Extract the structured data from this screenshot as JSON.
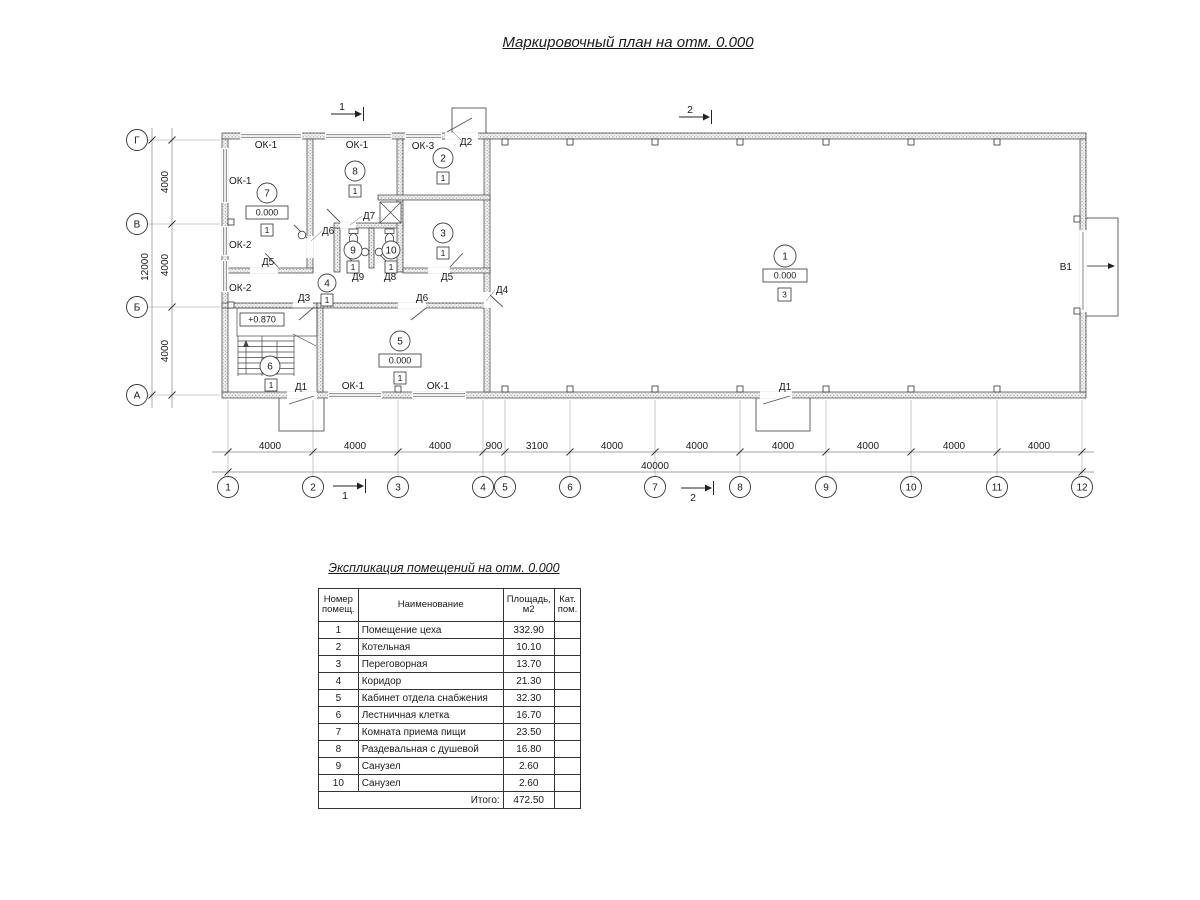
{
  "plan": {
    "title": "Маркировочный план на отм. 0.000",
    "col_axes": [
      "1",
      "2",
      "3",
      "4",
      "5",
      "6",
      "7",
      "8",
      "9",
      "10",
      "11",
      "12"
    ],
    "row_axes": [
      "Г",
      "В",
      "Б",
      "А"
    ],
    "dims_bottom": [
      "4000",
      "4000",
      "4000",
      "900",
      "3100",
      "4000",
      "4000",
      "4000",
      "4000",
      "4000",
      "4000"
    ],
    "total_width": "40000",
    "dims_left": [
      "4000",
      "4000",
      "4000"
    ],
    "total_height": "12000",
    "sections": {
      "s1": "1",
      "s2": "2"
    },
    "gate_label": "В1",
    "landing_level": "+0.870",
    "doors": [
      "Д2",
      "Д6",
      "Д7",
      "Д9",
      "Д8",
      "Д5",
      "Д5",
      "Д4",
      "Д3",
      "Д6",
      "Д1",
      "Д1"
    ],
    "windows": [
      "ОК-1",
      "ОК-1",
      "ОК-3",
      "ОК-1",
      "ОК-2",
      "ОК-2",
      "ОК-1",
      "ОК-1"
    ],
    "rooms": [
      {
        "num": "1",
        "level": "0.000",
        "cat": "3"
      },
      {
        "num": "2",
        "cat": "1"
      },
      {
        "num": "3",
        "cat": "1"
      },
      {
        "num": "4",
        "cat": "1"
      },
      {
        "num": "5",
        "level": "0.000",
        "cat": "1"
      },
      {
        "num": "6",
        "cat": "1"
      },
      {
        "num": "7",
        "level": "0.000",
        "cat": "1"
      },
      {
        "num": "8",
        "cat": "1"
      },
      {
        "num": "9",
        "cat": "1"
      },
      {
        "num": "10",
        "cat": "1"
      }
    ]
  },
  "schedule": {
    "title": "Экспликация помещений на отм. 0.000",
    "headers": {
      "num_l1": "Номер",
      "num_l2": "помещ.",
      "name": "Наименование",
      "area_l1": "Площадь,",
      "area_l2": "м2",
      "cat_l1": "Кат.",
      "cat_l2": "пом."
    },
    "rows": [
      {
        "num": "1",
        "name": "Помещение цеха",
        "area": "332.90",
        "cat": ""
      },
      {
        "num": "2",
        "name": "Котельная",
        "area": "10.10",
        "cat": ""
      },
      {
        "num": "3",
        "name": "Переговорная",
        "area": "13.70",
        "cat": ""
      },
      {
        "num": "4",
        "name": "Коридор",
        "area": "21.30",
        "cat": ""
      },
      {
        "num": "5",
        "name": "Кабинет отдела снабжения",
        "area": "32.30",
        "cat": ""
      },
      {
        "num": "6",
        "name": "Лестничная клетка",
        "area": "16.70",
        "cat": ""
      },
      {
        "num": "7",
        "name": "Комната приема пищи",
        "area": "23.50",
        "cat": ""
      },
      {
        "num": "8",
        "name": "Раздевальная с душевой",
        "area": "16.80",
        "cat": ""
      },
      {
        "num": "9",
        "name": "Санузел",
        "area": "2.60",
        "cat": ""
      },
      {
        "num": "10",
        "name": "Санузел",
        "area": "2.60",
        "cat": ""
      }
    ],
    "total_label": "Итого:",
    "total_value": "472.50"
  }
}
